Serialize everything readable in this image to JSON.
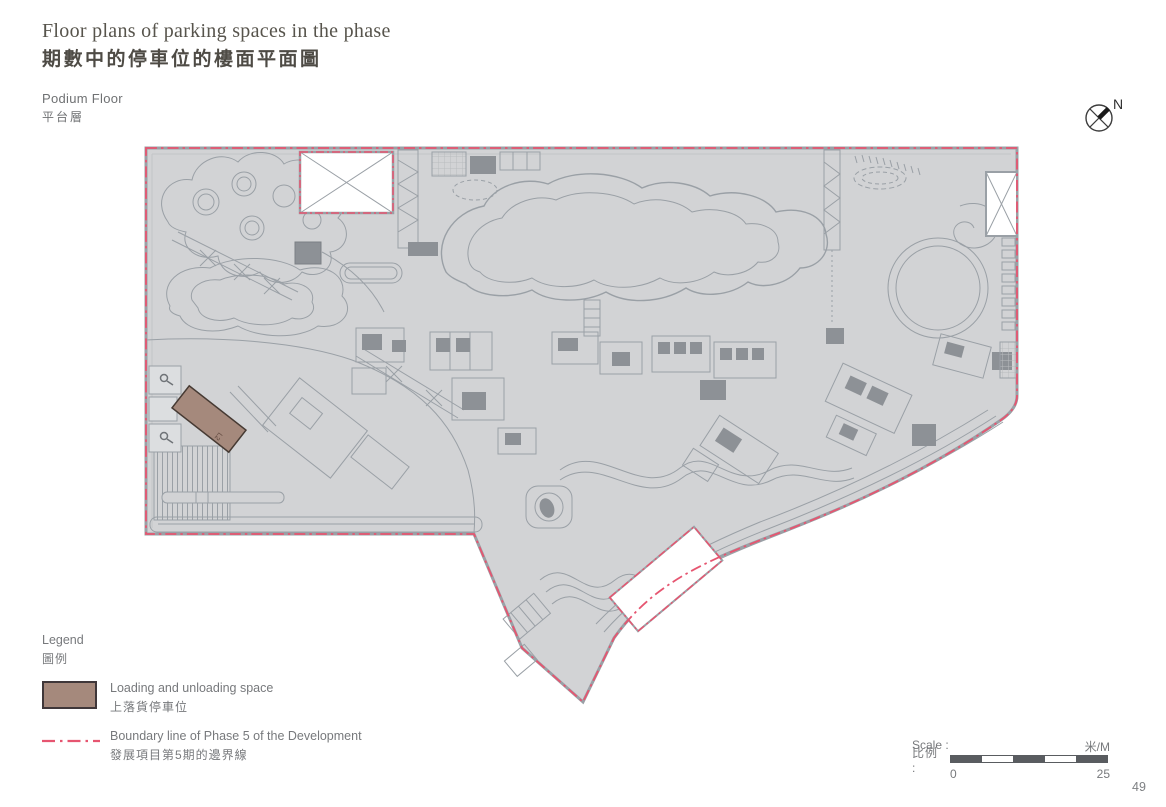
{
  "page": {
    "title_en": "Floor plans of parking spaces in the phase",
    "title_zh": "期數中的停車位的樓面平面圖",
    "floor_en": "Podium Floor",
    "floor_zh": "平台層",
    "page_number": "49"
  },
  "north_indicator": {
    "label": "N"
  },
  "plan": {
    "name": "Podium Floor parking plan",
    "base_fill": "#d2d3d5",
    "line_color": "#9aa0a6",
    "dark_fill": "#8d9196",
    "boundary_color": "#e65570",
    "loading_space_fill": "#a5897c",
    "loading_space_label": "L2"
  },
  "legend": {
    "title_en": "Legend",
    "title_zh": "圖例",
    "items": [
      {
        "key": "loading-unloading-space",
        "label_en": "Loading and unloading space",
        "label_zh": "上落貨停車位",
        "swatch_fill": "#a5897c",
        "swatch_border": "#3f3739"
      },
      {
        "key": "phase5-boundary-line",
        "label_en": "Boundary line of Phase 5 of the Development",
        "label_zh": "發展項目第5期的邊界線",
        "line_color": "#e65570"
      }
    ]
  },
  "scale_bar": {
    "label_en": "Scale :",
    "label_zh": "比例 :",
    "unit": "米/M",
    "start": "0",
    "end": "25",
    "bar_color": "#595c60"
  }
}
